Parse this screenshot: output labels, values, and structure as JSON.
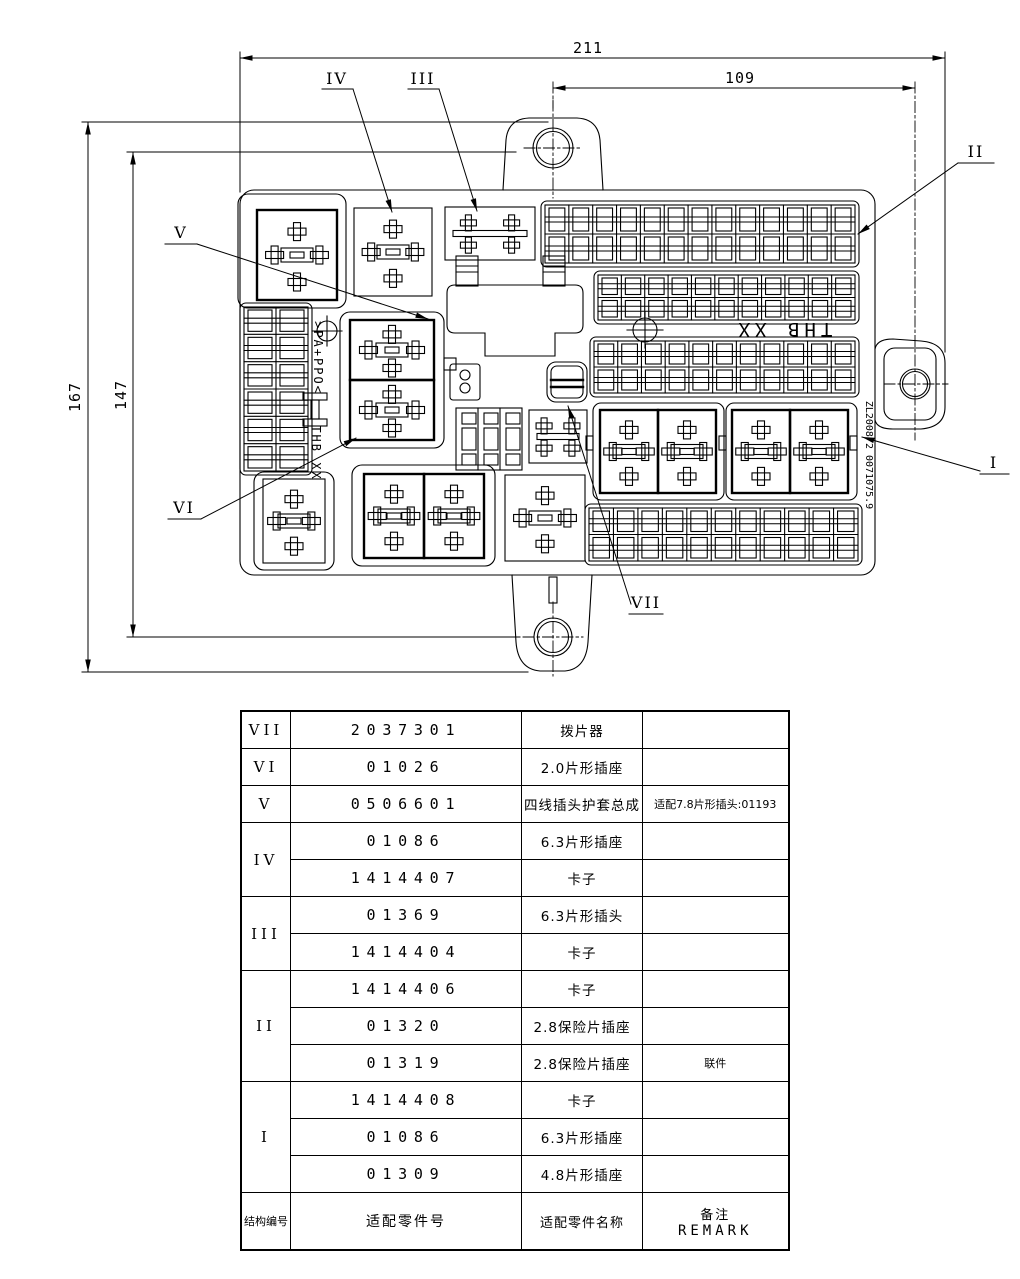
{
  "drawing": {
    "dimensions": {
      "total_width": "211",
      "right_width": "109",
      "total_height": "167",
      "inner_height": "147"
    },
    "labels": {
      "l1": "I",
      "l2": "II",
      "l3": "III",
      "l4": "IV",
      "l5": "V",
      "l6": "VI",
      "l7": "VII"
    },
    "texts": {
      "center_brand": "THB XX",
      "material_marking": ">PA+PPO<",
      "side_brand": "THB XX",
      "patent_number": "ZL2008 2 0071075.9"
    },
    "fuse_rows": [
      {
        "position": "top-right",
        "cols": 13,
        "rows": 2
      },
      {
        "position": "upper-middle-right",
        "cols": 11,
        "rows": 2
      },
      {
        "position": "lower-middle-right",
        "cols": 11,
        "rows": 2
      },
      {
        "position": "bottom-right",
        "cols": 11,
        "rows": 2
      },
      {
        "position": "left-column",
        "cols": 2,
        "rows": 6
      }
    ]
  },
  "table": {
    "headers": {
      "col_group": "结构编号",
      "col_part": "适配零件号",
      "col_name": "适配零件名称",
      "col_remark_cn": "备注",
      "col_remark_en": "REMARK"
    },
    "rows": [
      {
        "group": "VII",
        "part": "2037301",
        "name": "拨片器",
        "remark": ""
      },
      {
        "group": "VI",
        "part": "01026",
        "name": "2.0片形插座",
        "remark": ""
      },
      {
        "group": "V",
        "part": "0506601",
        "name": "四线插头护套总成",
        "remark": "适配7.8片形插头:01193"
      },
      {
        "group": "IV",
        "part": "01086",
        "name": "6.3片形插座",
        "remark": ""
      },
      {
        "group": "IV",
        "part": "1414407",
        "name": "卡子",
        "remark": ""
      },
      {
        "group": "III",
        "part": "01369",
        "name": "6.3片形插头",
        "remark": ""
      },
      {
        "group": "III",
        "part": "1414404",
        "name": "卡子",
        "remark": ""
      },
      {
        "group": "II",
        "part": "1414406",
        "name": "卡子",
        "remark": ""
      },
      {
        "group": "II",
        "part": "01320",
        "name": "2.8保险片插座",
        "remark": ""
      },
      {
        "group": "II",
        "part": "01319",
        "name": "2.8保险片插座",
        "remark": "联件"
      },
      {
        "group": "I",
        "part": "1414408",
        "name": "卡子",
        "remark": ""
      },
      {
        "group": "I",
        "part": "01086",
        "name": "6.3片形插座",
        "remark": ""
      },
      {
        "group": "I",
        "part": "01309",
        "name": "4.8片形插座",
        "remark": ""
      }
    ]
  }
}
